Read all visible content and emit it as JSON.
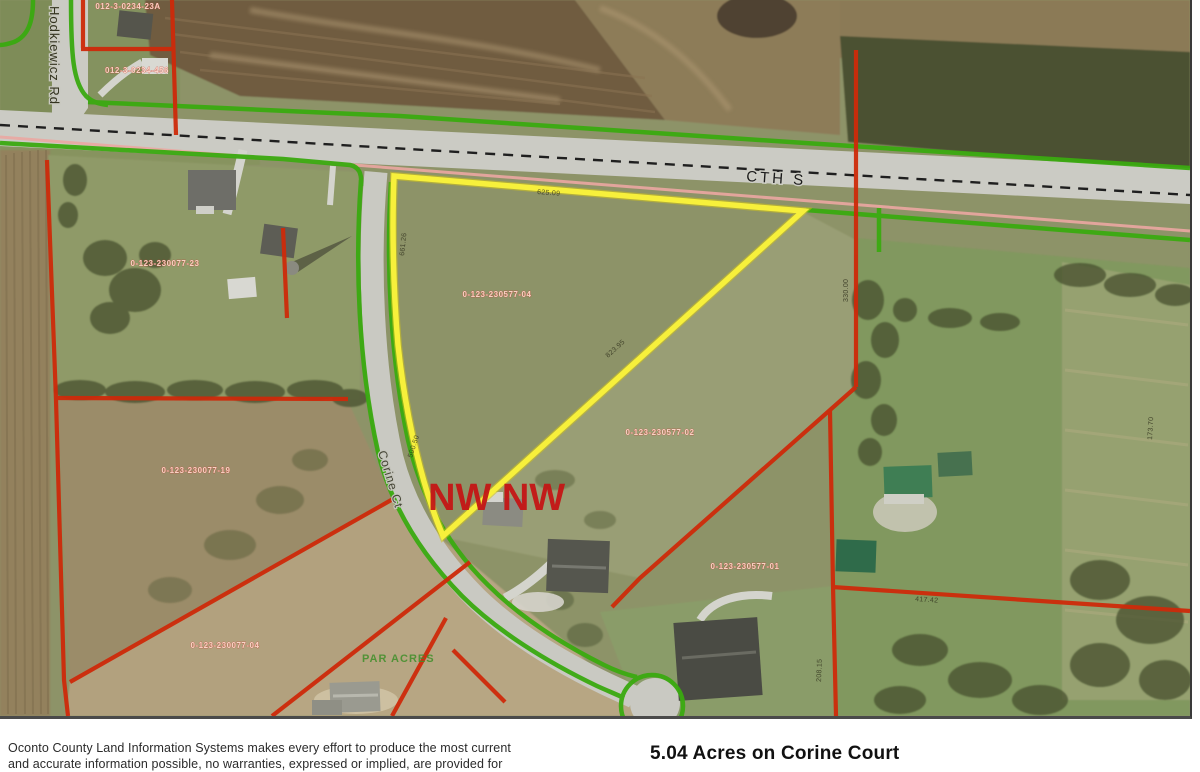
{
  "map": {
    "roads": {
      "hodkiewicz": "Hodkiewicz Rd",
      "cth_s": "CTH S",
      "corine": "Corine Ct"
    },
    "section_label": "NW NW",
    "subdivision_label": "PAR ACRES",
    "parcel_ids": [
      "012-3-0234-23A",
      "012-3-0234-456",
      "0-123-230077-23",
      "0-123-230577-04",
      "0-123-230577-02",
      "0-123-230577-01",
      "0-123-230077-19",
      "0-123-230077-04"
    ],
    "dimensions": [
      "661.26",
      "625.09",
      "823.95",
      "500.50",
      "330.00",
      "173.70",
      "417.42",
      "208.15"
    ],
    "line_colors": {
      "subject_parcel_highlight": "#f7f03b",
      "parcel_boundary": "#ce2a0a",
      "right_of_way": "#3aaa10",
      "section_line": "#eba8a2",
      "road_centerline": "#1f1f1f"
    }
  },
  "footer": {
    "disclaimer_line1": "Oconto County Land Information Systems makes every effort to produce the most current",
    "disclaimer_line2": "and accurate information possible, no warranties, expressed or implied, are provided for",
    "title": "5.04 Acres on Corine Court"
  }
}
